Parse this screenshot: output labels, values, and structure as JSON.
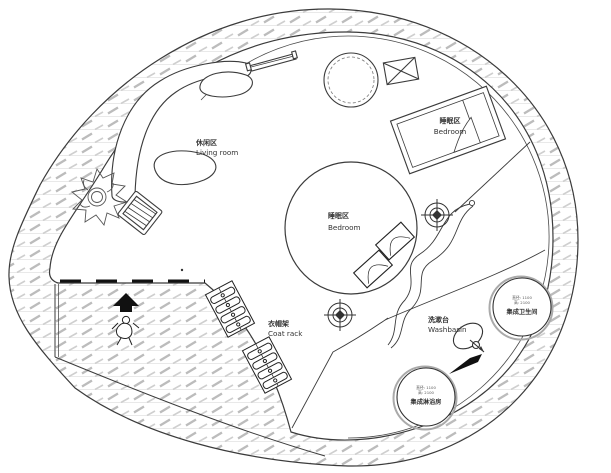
{
  "plan": {
    "title": "circular-tiny-house-floor-plan",
    "areas": {
      "living": {
        "zh": "休闲区",
        "en": "Living room"
      },
      "bedroom_upper": {
        "zh": "睡眠区",
        "en": "Bedroom"
      },
      "bedroom_center": {
        "zh": "睡眠区",
        "en": "Bedroom"
      },
      "coat_rack": {
        "zh": "衣帽架",
        "en": "Coat rack"
      },
      "washbasin": {
        "zh": "洗漱台",
        "en": "Washbasin"
      }
    },
    "pods": {
      "toilet": {
        "name": "集成卫生间",
        "spec_diameter": "直径: 1100",
        "spec_height": "高: 2100"
      },
      "shower": {
        "name": "集成淋浴房",
        "spec_diameter": "直径: 1100",
        "spec_height": "高: 2100"
      }
    },
    "colors": {
      "line": "#3b3b3b",
      "hatch_dash": "#bcbcbc",
      "hatch_line": "#e0e0e0",
      "background": "#ffffff"
    }
  }
}
